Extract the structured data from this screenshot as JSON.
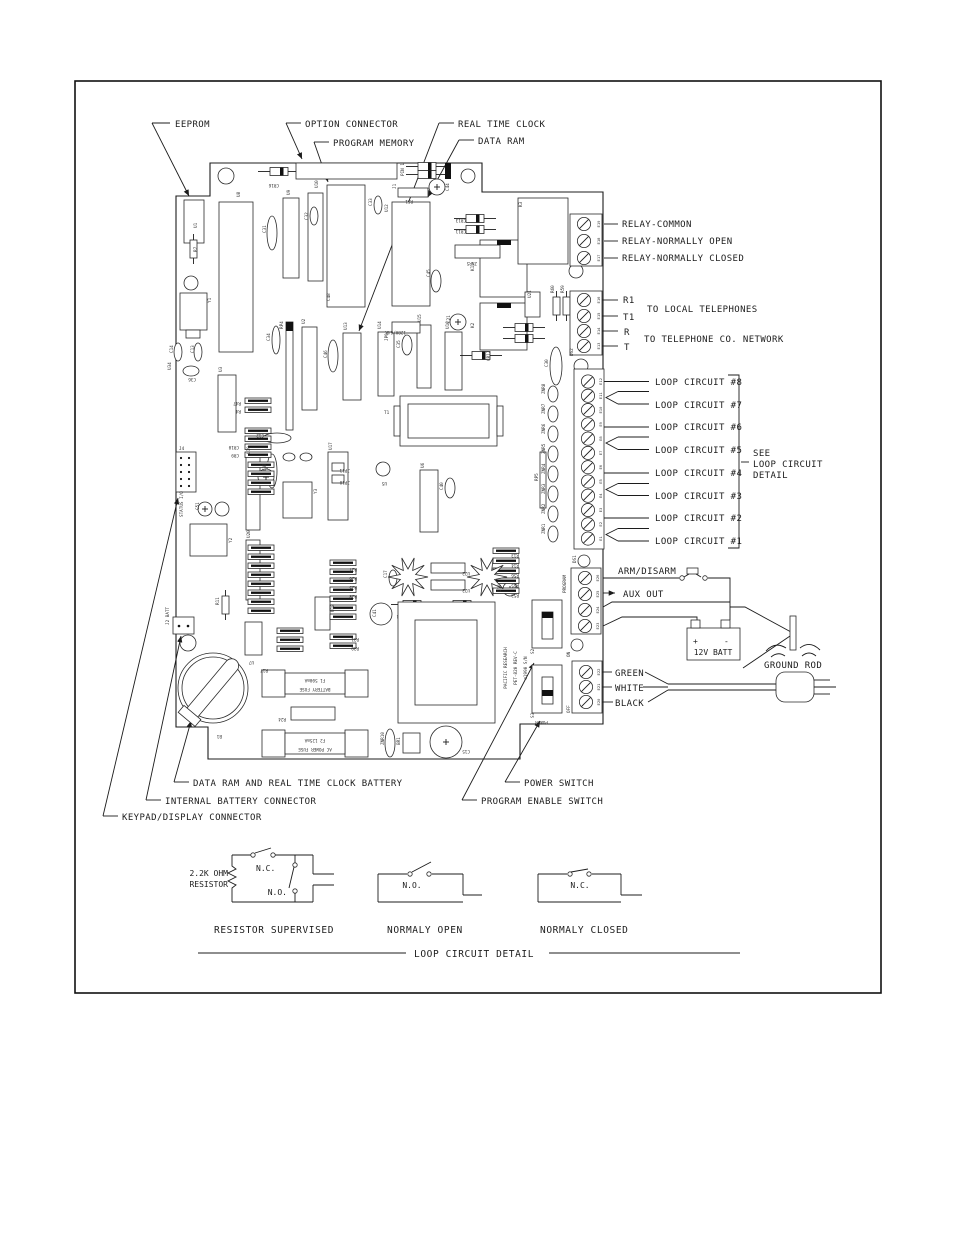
{
  "callouts": {
    "top": [
      {
        "label": "EEPROM"
      },
      {
        "label": "OPTION CONNECTOR"
      },
      {
        "label": "PROGRAM MEMORY"
      },
      {
        "label": "REAL TIME CLOCK"
      },
      {
        "label": "DATA RAM"
      }
    ],
    "bottom": [
      {
        "label": "DATA RAM AND REAL TIME CLOCK BATTERY"
      },
      {
        "label": "INTERNAL BATTERY CONNECTOR"
      },
      {
        "label": "KEYPAD/DISPLAY CONNECTOR"
      },
      {
        "label": "POWER SWITCH"
      },
      {
        "label": "PROGRAM ENABLE SWITCH"
      }
    ]
  },
  "right_panel": {
    "relay": [
      "RELAY-COMMON",
      "RELAY-NORMALLY OPEN",
      "RELAY-NORMALLY CLOSED"
    ],
    "phone_terminals": [
      "R1",
      "T1",
      "R",
      "T"
    ],
    "phone_notes": [
      "TO LOCAL TELEPHONES",
      "TO TELEPHONE CO. NETWORK"
    ],
    "loops": [
      "LOOP CIRCUIT #8",
      "LOOP CIRCUIT #7",
      "LOOP CIRCUIT #6",
      "LOOP CIRCUIT #5",
      "LOOP CIRCUIT #4",
      "LOOP CIRCUIT #3",
      "LOOP CIRCUIT #2",
      "LOOP CIRCUIT #1"
    ],
    "see_note": [
      "SEE",
      "LOOP  CIRCUIT",
      "DETAIL"
    ],
    "arm_disarm": "ARM/DISARM",
    "aux_out": "AUX  OUT",
    "battery_label": "12V  BATT",
    "battery_plus": "+",
    "battery_minus": "-",
    "ground_rod": "GROUND  ROD",
    "ac_wires": [
      "GREEN",
      "WHITE",
      "BLACK"
    ]
  },
  "board": {
    "silkscreen": [
      "PACIFIC RESEARCH",
      "PET-820  REV-C",
      "©1990  S/N"
    ],
    "strips": {
      "relay": [
        "E19",
        "E18",
        "E17"
      ],
      "phone": [
        "E16",
        "E15",
        "E14",
        "E13"
      ],
      "loop": [
        "E12",
        "E11",
        "E10",
        "E9",
        "E8",
        "E7",
        "E6",
        "E5",
        "E4",
        "E3",
        "E2",
        "E1"
      ],
      "program": [
        "E26",
        "E25",
        "E24",
        "E23"
      ],
      "power": [
        "E22",
        "E21",
        "E20"
      ]
    },
    "fuses": {
      "battery": [
        "F1  500mA",
        "BATTERY FUSE"
      ],
      "ac": [
        "F2  125mA",
        "AC POWER FUSE"
      ]
    },
    "components": [
      [
        "U1",
        197,
        228,
        -90
      ],
      [
        "R7",
        197,
        252,
        -90
      ],
      [
        "Y1",
        211,
        303,
        -90
      ],
      [
        "U8",
        240,
        197,
        -90
      ],
      [
        "C31",
        266,
        233,
        -90
      ],
      [
        "U9",
        290,
        195,
        -90
      ],
      [
        "C32",
        308,
        220,
        -90
      ],
      [
        "U10",
        318,
        188,
        -90
      ],
      [
        "C33",
        372,
        206,
        -90
      ],
      [
        "J1",
        396,
        189,
        -90
      ],
      [
        "PIN 1",
        404,
        176,
        -90
      ],
      [
        "U12",
        388,
        212,
        -90
      ],
      [
        "R51",
        413,
        200,
        180
      ],
      [
        "C44",
        449,
        191,
        -90
      ],
      [
        "CR16",
        279,
        184,
        180
      ],
      [
        "CR13",
        466,
        219,
        180
      ],
      [
        "CR11",
        466,
        230,
        180
      ],
      [
        "ZNR5",
        477,
        262,
        180
      ],
      [
        "K1",
        474,
        271,
        -90
      ],
      [
        "K2",
        474,
        328,
        -90
      ],
      [
        "K3",
        522,
        207,
        -90
      ],
      [
        "U21",
        531,
        298,
        -90
      ],
      [
        "R60",
        554,
        293,
        -90
      ],
      [
        "R59",
        564,
        293,
        -90
      ],
      [
        "C30",
        548,
        367,
        -90
      ],
      [
        "DS2",
        573,
        356,
        -90
      ],
      [
        "C21",
        450,
        323,
        -90
      ],
      [
        "CR12",
        490,
        361,
        -90
      ],
      [
        "C34",
        270,
        341,
        -90
      ],
      [
        "RP4",
        283,
        329,
        -90
      ],
      [
        "U2",
        305,
        324,
        -90
      ],
      [
        "C46",
        327,
        358,
        -90
      ],
      [
        "U13",
        347,
        330,
        -90
      ],
      [
        "C45",
        430,
        277,
        -90
      ],
      [
        "U14",
        381,
        329,
        -90
      ],
      [
        "JP9",
        388,
        341,
        -90
      ],
      [
        "128K/64K",
        406,
        331,
        180
      ],
      [
        "C35",
        400,
        348,
        -90
      ],
      [
        "U15",
        421,
        322,
        -90
      ],
      [
        "U16",
        449,
        329,
        -90
      ],
      [
        "T1",
        384,
        414,
        0
      ],
      [
        "U34",
        171,
        370,
        -90
      ],
      [
        "C36",
        196,
        378,
        180
      ],
      [
        "C14",
        173,
        353,
        -90
      ],
      [
        "C13",
        194,
        353,
        -90
      ],
      [
        "U3",
        222,
        372,
        -90
      ],
      [
        "R47",
        241,
        402,
        180
      ],
      [
        "R4",
        241,
        410,
        180
      ],
      [
        "CR10",
        239,
        446,
        180
      ],
      [
        "CR9",
        239,
        454,
        180
      ],
      [
        "C12",
        264,
        434,
        180
      ],
      [
        "JP11",
        350,
        469,
        180
      ],
      [
        "JP10",
        350,
        481,
        180
      ],
      [
        "J4",
        179,
        450,
        0
      ],
      [
        "STATUS I/O",
        183,
        517,
        -90
      ],
      [
        "J2 BATT",
        169,
        625,
        -90
      ],
      [
        "R11",
        219,
        605,
        -90
      ],
      [
        "Y2",
        232,
        543,
        -90
      ],
      [
        "U19",
        250,
        454,
        -90
      ],
      [
        "U20",
        250,
        538,
        -90
      ],
      [
        "C37",
        266,
        471,
        -90
      ],
      [
        "U17",
        332,
        450,
        -90
      ],
      [
        "Y3",
        317,
        494,
        -90
      ],
      [
        "U18",
        334,
        612,
        -90
      ],
      [
        "U6",
        424,
        468,
        -90
      ],
      [
        "U5",
        387,
        482,
        180
      ],
      [
        "C40",
        443,
        490,
        -90
      ],
      [
        "C17",
        387,
        578,
        -90
      ],
      [
        "C41",
        376,
        617,
        -90
      ],
      [
        "D16",
        501,
        592,
        -90
      ],
      [
        "RP5",
        538,
        481,
        -90
      ],
      [
        "U22",
        470,
        572,
        180
      ],
      [
        "U23",
        470,
        589,
        180
      ],
      [
        "CR14",
        407,
        615,
        180
      ],
      [
        "CR15",
        458,
        615,
        180
      ],
      [
        "R27",
        357,
        568,
        180
      ],
      [
        "R26",
        357,
        577,
        180
      ],
      [
        "R25",
        357,
        586,
        180
      ],
      [
        "R28",
        357,
        595,
        180
      ],
      [
        "R31",
        359,
        638,
        180
      ],
      [
        "R30",
        359,
        647,
        180
      ],
      [
        "R13",
        519,
        554,
        180
      ],
      [
        "R14",
        519,
        564,
        180
      ],
      [
        "R56",
        519,
        574,
        180
      ],
      [
        "R55",
        519,
        584,
        180
      ],
      [
        "R53",
        519,
        594,
        180
      ],
      [
        "R24",
        286,
        718,
        180
      ],
      [
        "U7",
        254,
        661,
        180
      ],
      [
        "R17",
        268,
        669,
        180
      ],
      [
        "B1",
        222,
        735,
        180
      ],
      [
        "ZNR10",
        384,
        745,
        -90
      ],
      [
        "BR1",
        400,
        745,
        -90
      ],
      [
        "C15",
        470,
        750,
        180
      ],
      [
        "S2",
        534,
        654,
        -90
      ],
      [
        "S3",
        534,
        718,
        -90
      ],
      [
        "POWER",
        548,
        721,
        180
      ],
      [
        "PROGRAM",
        566,
        593,
        -90
      ],
      [
        "ON",
        570,
        657,
        -90
      ],
      [
        "OFF",
        570,
        713,
        -90
      ],
      [
        "DS1",
        576,
        563,
        -90
      ],
      [
        "ZNR8",
        545,
        394,
        -90
      ],
      [
        "ZNR7",
        545,
        414,
        -90
      ],
      [
        "ZNR6",
        545,
        434,
        -90
      ],
      [
        "ZNR5",
        545,
        454,
        -90
      ],
      [
        "ZNR4",
        545,
        474,
        -90
      ],
      [
        "ZNR3",
        545,
        494,
        -90
      ],
      [
        "ZNR2",
        545,
        514,
        -90
      ],
      [
        "ZNR1",
        545,
        534,
        -90
      ],
      [
        "C51",
        199,
        510,
        -90
      ],
      [
        "C48",
        330,
        301,
        -90
      ]
    ]
  },
  "detail": {
    "resistor_label": [
      "2.2K OHM",
      "RESISTOR"
    ],
    "sw1_nc": "N.C.",
    "sw1_no": "N.O.",
    "sw2_no": "N.O.",
    "sw3_nc": "N.C.",
    "captions": [
      "RESISTOR SUPERVISED",
      "NORMALY OPEN",
      "NORMALY CLOSED"
    ],
    "title": "LOOP CIRCUIT DETAIL"
  }
}
